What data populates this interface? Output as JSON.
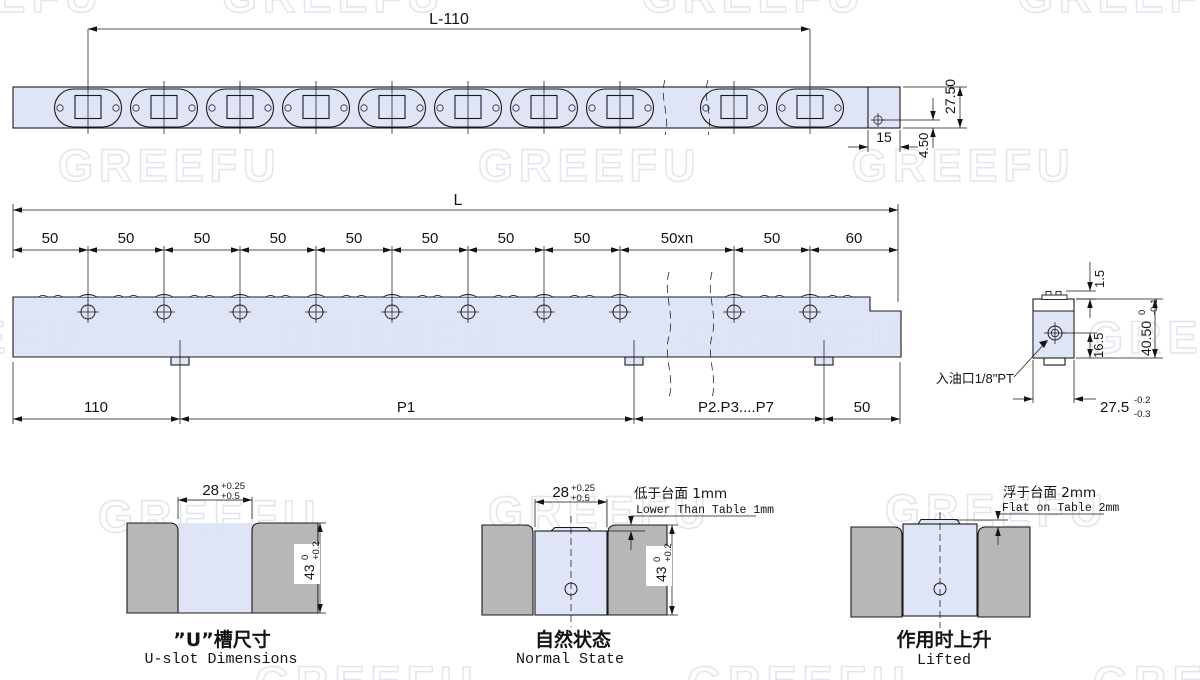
{
  "watermark": {
    "text": "GREEFU",
    "color": "#e4e4ee"
  },
  "colors": {
    "rail_fill": "#dbe2f5",
    "table_fill": "#b1b1b1",
    "line": "#1a1a1a"
  },
  "top_view": {
    "length_dim": "L-110",
    "height_dim": "27.50",
    "hole_offset_dim": "4.50",
    "end_dim": "15"
  },
  "front_view": {
    "overall_dim": "L",
    "pitch_dims": [
      "50",
      "50",
      "50",
      "50",
      "50",
      "50",
      "50",
      "50",
      "50xn",
      "50",
      "60"
    ],
    "bottom_dims": [
      "110",
      "P1",
      "P2.P3....P7",
      "50"
    ]
  },
  "section_view": {
    "protrusion_dim": "1.5",
    "port_depth_dim": "16.5",
    "height_dim": "40.50",
    "height_tol_upper": "0",
    "height_tol_lower": "-0.1",
    "width_dim": "27.5",
    "width_tol_upper": "-0.2",
    "width_tol_lower": "-0.3",
    "oil_port_label": "入油口1/8\"PT"
  },
  "details": {
    "u_slot": {
      "width_dim": "28",
      "width_tol_upper": "+0.25",
      "width_tol_lower": "+0.5",
      "depth_dim": "43",
      "depth_tol_upper": "0",
      "depth_tol_lower": "+0.2",
      "caption_cn": "”U”槽尺寸",
      "caption_en": "U-slot Dimensions"
    },
    "normal": {
      "width_dim": "28",
      "width_tol_upper": "+0.25",
      "width_tol_lower": "+0.5",
      "depth_dim": "43",
      "depth_tol_upper": "0",
      "depth_tol_lower": "+0.2",
      "note_cn": "低于台面 1mm",
      "note_en": "Lower Than Table 1mm",
      "caption_cn": "自然状态",
      "caption_en": "Normal State"
    },
    "lifted": {
      "note_cn": "浮于台面 2mm",
      "note_en": "Flat on Table 2mm",
      "caption_cn": "作用时上升",
      "caption_en": "Lifted"
    }
  }
}
